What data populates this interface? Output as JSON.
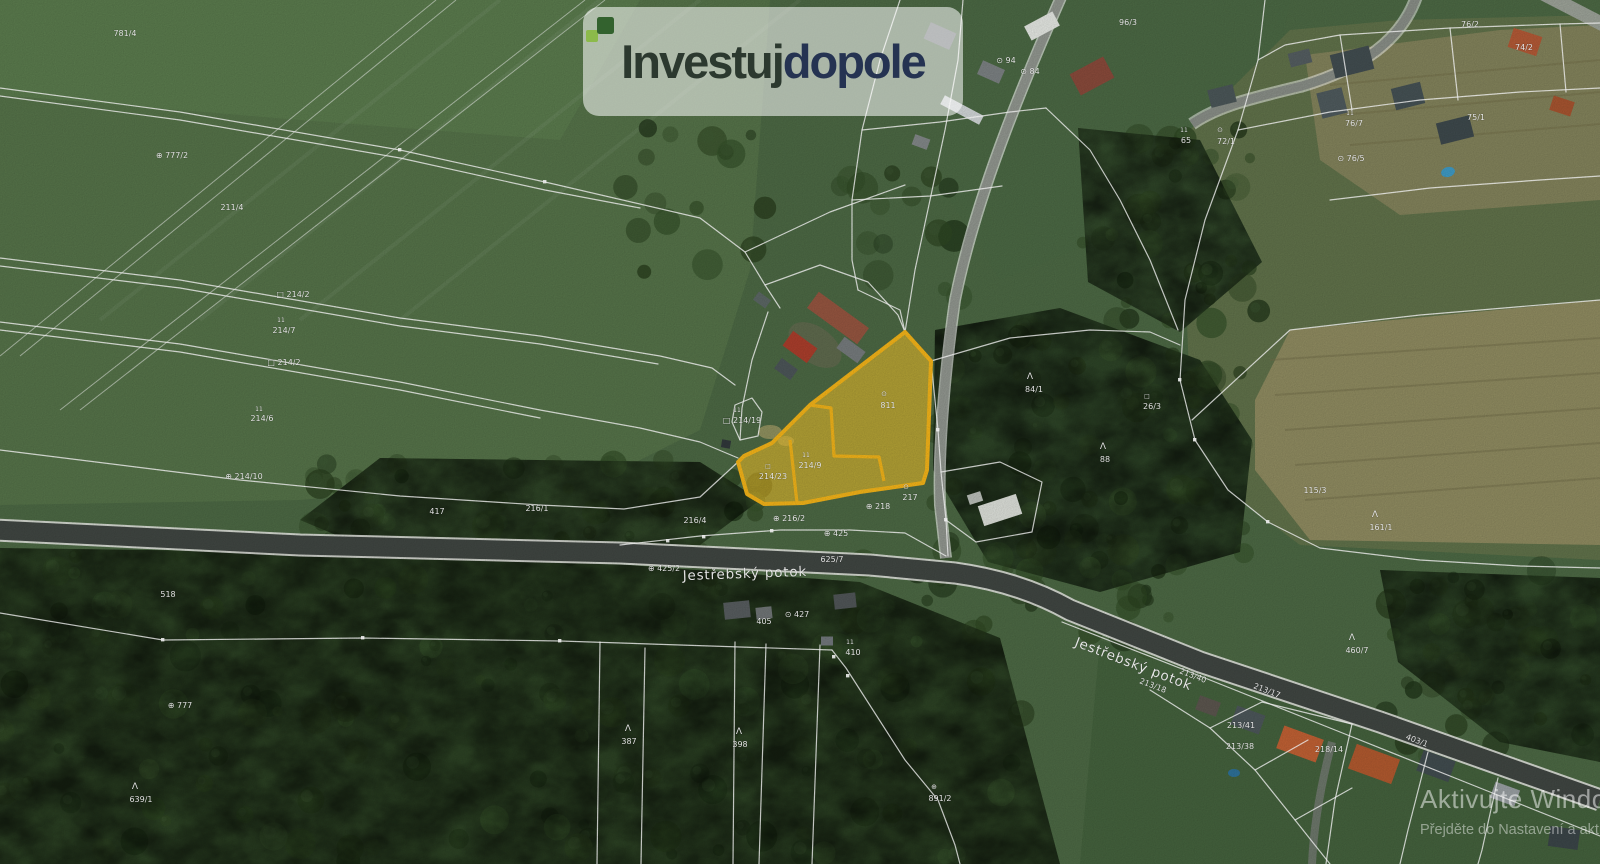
{
  "logo": {
    "icon": "growth-squares-icon",
    "part1": "Investuj",
    "part2": "dopole",
    "icon_color_light": "#8cba4a",
    "icon_color_dark": "#33622e"
  },
  "watermark": {
    "line1": "Aktivujte Windows",
    "line2": "Přejděte do Nastavení a aktivujte systém Windows."
  },
  "map": {
    "highlighted_parcel": {
      "fill": "#f6c52a",
      "stroke": "#f0b118",
      "parcel_numbers": [
        "214/9",
        "214/23",
        "811"
      ],
      "outline": [
        [
          905,
          332
        ],
        [
          931,
          361
        ],
        [
          927,
          470
        ],
        [
          923,
          483
        ],
        [
          860,
          492
        ],
        [
          803,
          503
        ],
        [
          764,
          504
        ],
        [
          747,
          494
        ],
        [
          738,
          462
        ],
        [
          744,
          456
        ],
        [
          772,
          443
        ],
        [
          810,
          405
        ]
      ],
      "inner_borders": [
        [
          [
            810,
            405
          ],
          [
            831,
            408
          ],
          [
            834,
            456
          ],
          [
            879,
            457
          ],
          [
            884,
            481
          ]
        ],
        [
          [
            790,
            440
          ],
          [
            797,
            503
          ]
        ]
      ]
    },
    "stream_labels": [
      {
        "text": "Jestřebský potok",
        "x": 745,
        "y": 578,
        "rot": -2
      },
      {
        "text": "Jestřebský potok",
        "x": 1132,
        "y": 668,
        "rot": 21
      }
    ],
    "parcel_labels": [
      {
        "text": "781/4",
        "x": 125,
        "y": 36
      },
      {
        "text": "⊕ 777/2",
        "x": 172,
        "y": 158
      },
      {
        "text": "211/4",
        "x": 232,
        "y": 210
      },
      {
        "text": "□ 214/2",
        "x": 293,
        "y": 297
      },
      {
        "text": "11",
        "x": 281,
        "y": 322,
        "s": 6
      },
      {
        "text": "214/7",
        "x": 284,
        "y": 333
      },
      {
        "text": "□ 214/2",
        "x": 284,
        "y": 365
      },
      {
        "text": "11",
        "x": 259,
        "y": 411,
        "s": 6
      },
      {
        "text": "214/6",
        "x": 262,
        "y": 421
      },
      {
        "text": "⊕ 214/10",
        "x": 244,
        "y": 479
      },
      {
        "text": "417",
        "x": 437,
        "y": 514
      },
      {
        "text": "216/1",
        "x": 537,
        "y": 511
      },
      {
        "text": "518",
        "x": 168,
        "y": 597
      },
      {
        "text": "216/4",
        "x": 695,
        "y": 523
      },
      {
        "text": "⊕ 216/2",
        "x": 789,
        "y": 521
      },
      {
        "text": "⊕ 425",
        "x": 836,
        "y": 536
      },
      {
        "text": "⊕ 425/2",
        "x": 664,
        "y": 571
      },
      {
        "text": "625/7",
        "x": 832,
        "y": 562
      },
      {
        "text": "11",
        "x": 737,
        "y": 412,
        "s": 6
      },
      {
        "text": "□ 214/19",
        "x": 742,
        "y": 423
      },
      {
        "text": "⊙",
        "x": 884,
        "y": 396,
        "s": 7
      },
      {
        "text": "811",
        "x": 888,
        "y": 408
      },
      {
        "text": "11",
        "x": 806,
        "y": 457,
        "s": 6
      },
      {
        "text": "214/9",
        "x": 810,
        "y": 468
      },
      {
        "text": "□",
        "x": 768,
        "y": 468,
        "s": 6
      },
      {
        "text": "214/23",
        "x": 773,
        "y": 479
      },
      {
        "text": "⊙",
        "x": 906,
        "y": 489,
        "s": 7
      },
      {
        "text": "217",
        "x": 910,
        "y": 500
      },
      {
        "text": "⊕ 218",
        "x": 878,
        "y": 509
      },
      {
        "text": "405",
        "x": 764,
        "y": 624
      },
      {
        "text": "⊙ 427",
        "x": 797,
        "y": 617
      },
      {
        "text": "11",
        "x": 850,
        "y": 644,
        "s": 6
      },
      {
        "text": "410",
        "x": 853,
        "y": 655
      },
      {
        "text": "Λ",
        "x": 739,
        "y": 734,
        "s": 9
      },
      {
        "text": "398",
        "x": 740,
        "y": 747
      },
      {
        "text": "Λ",
        "x": 628,
        "y": 731,
        "s": 9
      },
      {
        "text": "387",
        "x": 629,
        "y": 744
      },
      {
        "text": "Λ",
        "x": 135,
        "y": 789,
        "s": 9
      },
      {
        "text": "639/1",
        "x": 141,
        "y": 802
      },
      {
        "text": "⊕ 777",
        "x": 180,
        "y": 708
      },
      {
        "text": "⊕",
        "x": 934,
        "y": 789,
        "s": 7
      },
      {
        "text": "891/2",
        "x": 940,
        "y": 801
      },
      {
        "text": "Λ",
        "x": 1030,
        "y": 379,
        "s": 9
      },
      {
        "text": "84/1",
        "x": 1034,
        "y": 392
      },
      {
        "text": "Λ",
        "x": 1103,
        "y": 449,
        "s": 9
      },
      {
        "text": "88",
        "x": 1105,
        "y": 462
      },
      {
        "text": "□",
        "x": 1147,
        "y": 398,
        "s": 6
      },
      {
        "text": "26/3",
        "x": 1152,
        "y": 409
      },
      {
        "text": "⊙ 84",
        "x": 1030,
        "y": 74
      },
      {
        "text": "⊙ 94",
        "x": 1006,
        "y": 63
      },
      {
        "text": "96/3",
        "x": 1128,
        "y": 25
      },
      {
        "text": "11",
        "x": 1184,
        "y": 132,
        "s": 6
      },
      {
        "text": "65",
        "x": 1186,
        "y": 143
      },
      {
        "text": "⊙",
        "x": 1220,
        "y": 132,
        "s": 7
      },
      {
        "text": "72/1",
        "x": 1226,
        "y": 144
      },
      {
        "text": "11",
        "x": 1350,
        "y": 115,
        "s": 6
      },
      {
        "text": "76/7",
        "x": 1354,
        "y": 126
      },
      {
        "text": "⊙ 76/5",
        "x": 1351,
        "y": 161
      },
      {
        "text": "76/2",
        "x": 1470,
        "y": 27
      },
      {
        "text": "74/2",
        "x": 1524,
        "y": 50
      },
      {
        "text": "75/1",
        "x": 1476,
        "y": 120
      },
      {
        "text": "Λ",
        "x": 1375,
        "y": 517,
        "s": 9
      },
      {
        "text": "161/1",
        "x": 1381,
        "y": 530
      },
      {
        "text": "115/3",
        "x": 1315,
        "y": 493
      },
      {
        "text": "Λ",
        "x": 1352,
        "y": 640,
        "s": 9
      },
      {
        "text": "460/7",
        "x": 1357,
        "y": 653
      },
      {
        "text": "213/18",
        "x": 1152,
        "y": 688,
        "rot": 21
      },
      {
        "text": "213/40",
        "x": 1192,
        "y": 678,
        "rot": 21
      },
      {
        "text": "213/17",
        "x": 1266,
        "y": 693,
        "rot": 21
      },
      {
        "text": "213/41",
        "x": 1241,
        "y": 728
      },
      {
        "text": "213/38",
        "x": 1240,
        "y": 749
      },
      {
        "text": "218/14",
        "x": 1329,
        "y": 752
      },
      {
        "text": "403/1",
        "x": 1416,
        "y": 743,
        "rot": 21
      }
    ]
  }
}
